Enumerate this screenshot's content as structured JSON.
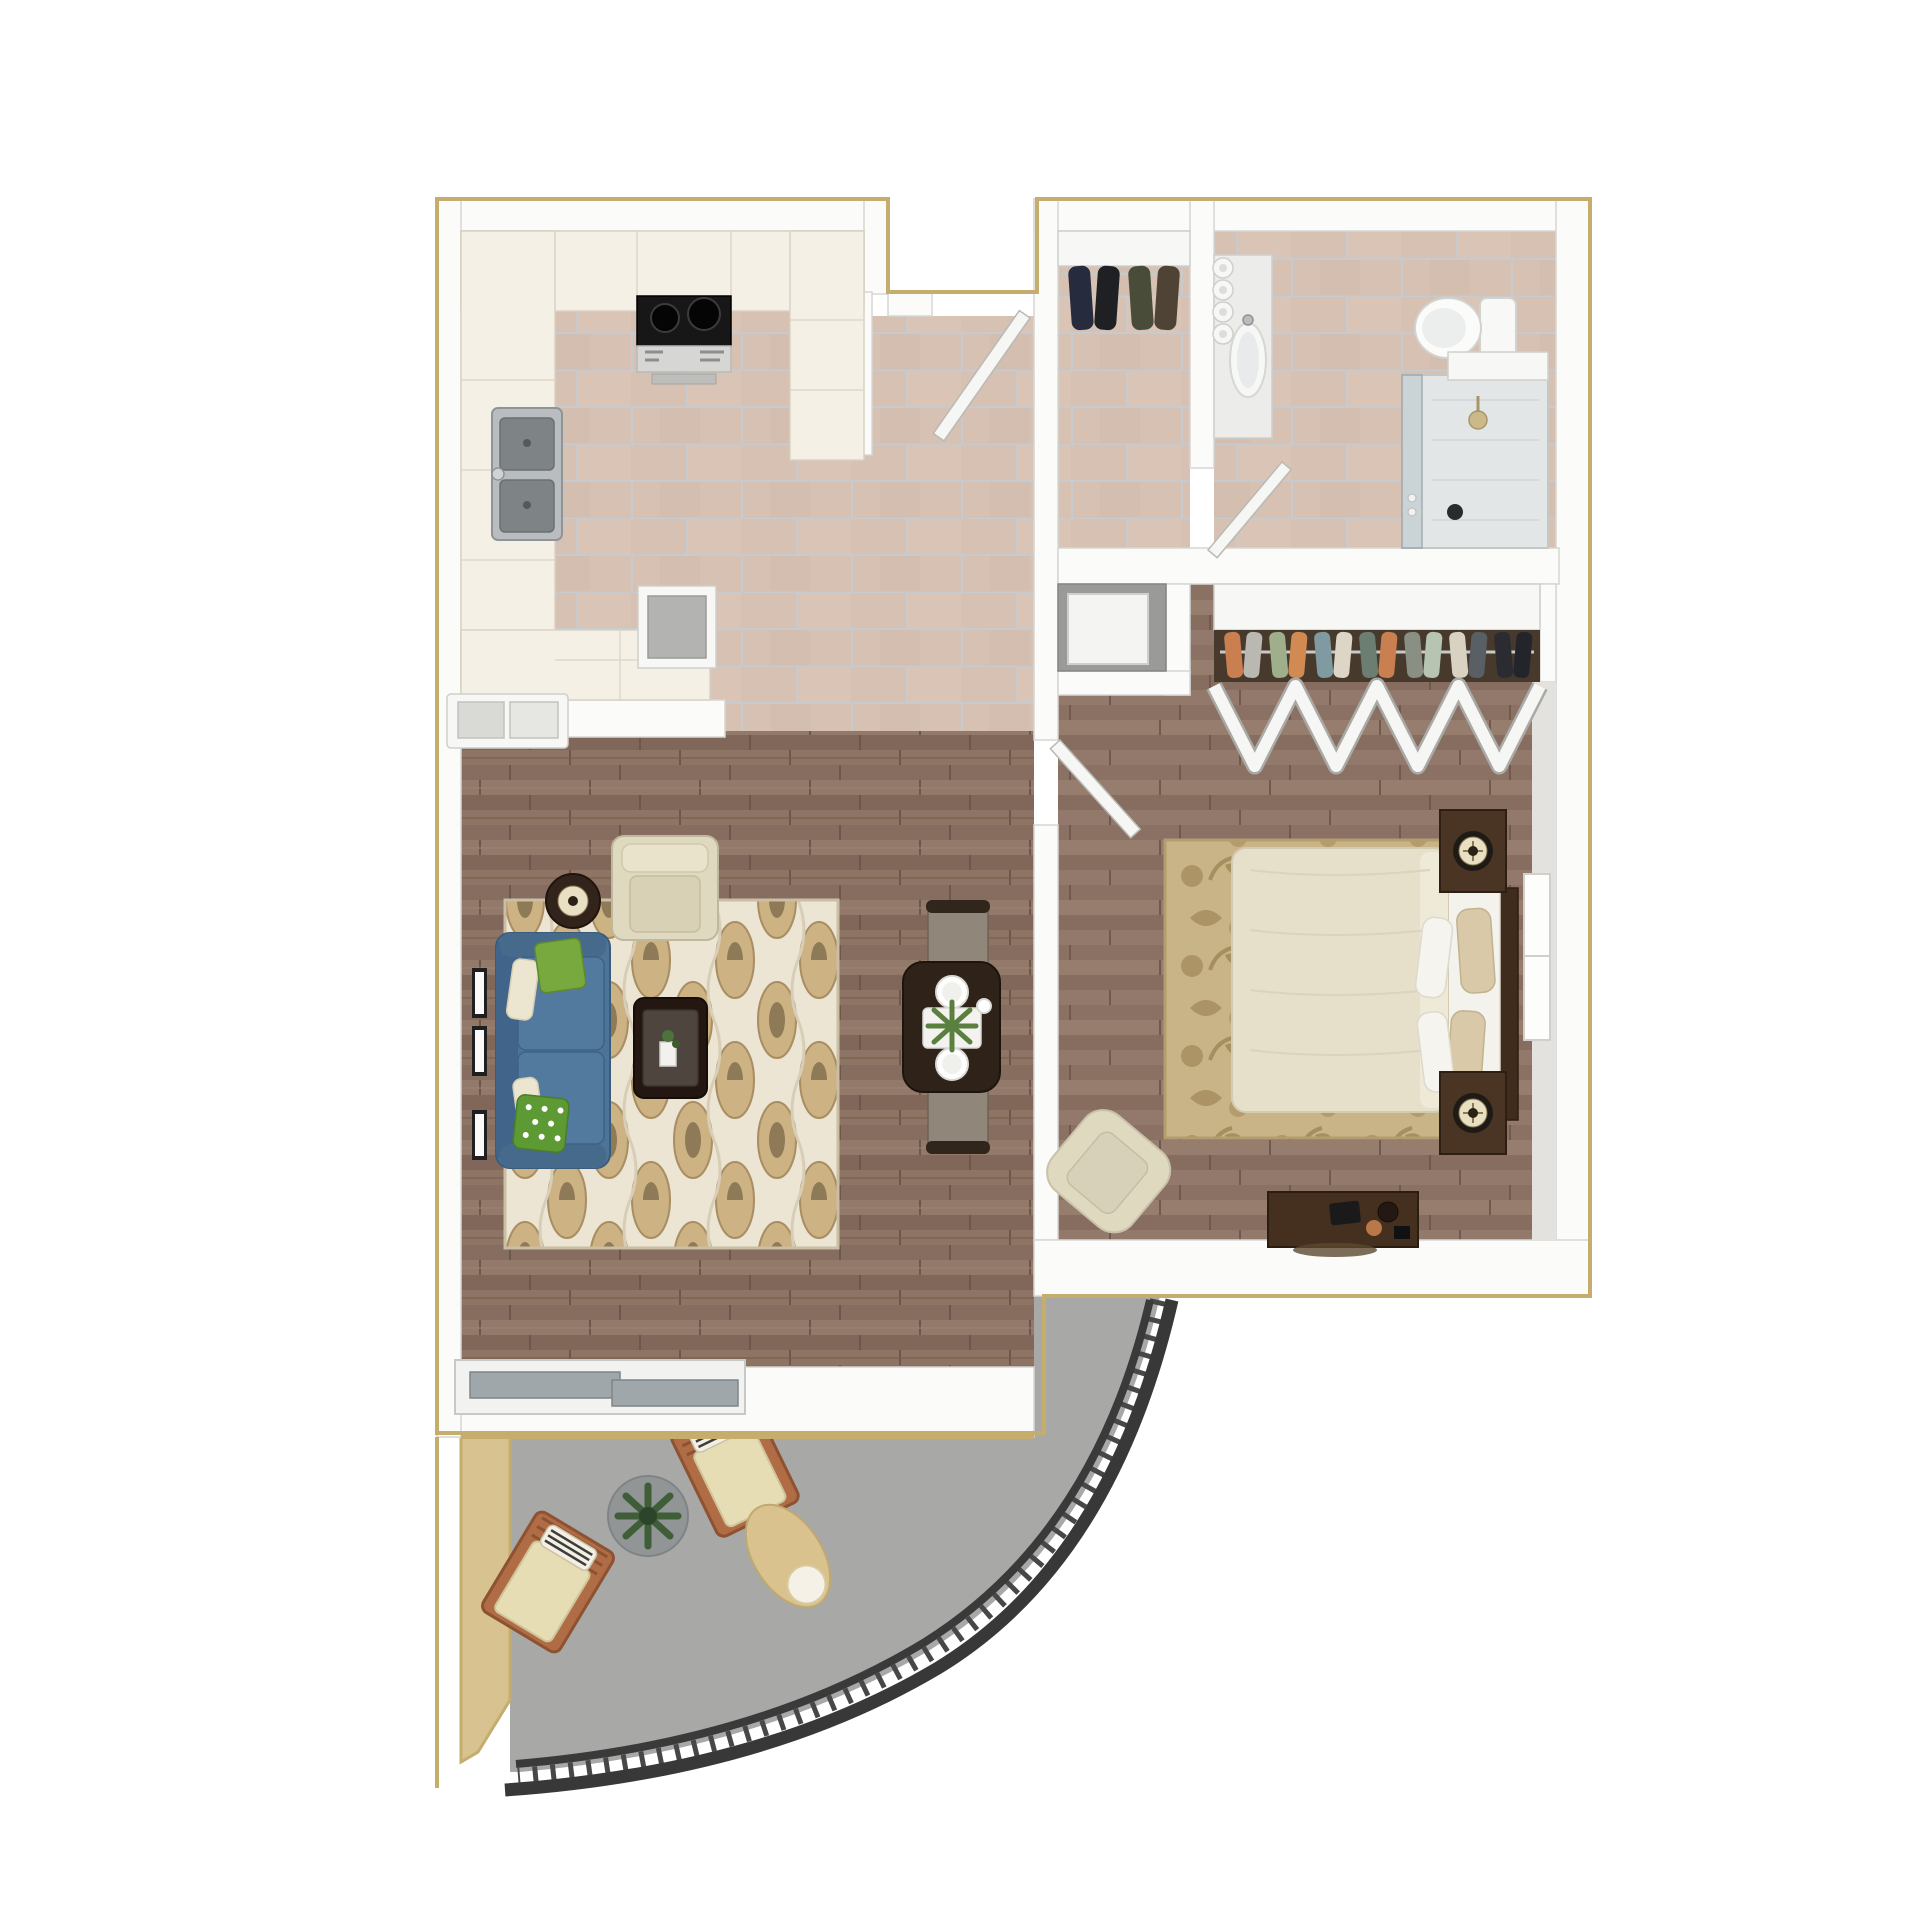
{
  "page": {
    "kind": "3d-floor-plan-render",
    "description": "Top-down 3D render of a one-bedroom apartment floor plan with curved balcony",
    "background": "#ffffff"
  },
  "colors": {
    "gold_trim": "#c5ad6e",
    "wall_white": "#fbfbfa",
    "tile_grout": "#c3ccd4",
    "tile_base": "#d7c1b2",
    "sofa_blue": "#4d7497",
    "sofa_blue_dark": "#41658a",
    "pillow_green": "#77a93e",
    "pillow_cream": "#ece5cf",
    "rug_living_base": "#ece5d4",
    "rug_living_motif": "#cdb283",
    "armchair_cream": "#dfd9c0",
    "coffee_table_dark": "#241711",
    "dining_table_dark": "#2f2319",
    "dining_chair": "#90867a",
    "comforter_cream": "#e6dfca",
    "bed_rug_base": "#c9b488",
    "bed_rug_motif": "#ab9365",
    "nightstand_wood": "#4a3424",
    "headboard_wood": "#3f2c1d",
    "dresser_wood": "#452f1f",
    "balcony_floor": "#a8a8a6",
    "balcony_wall_tan": "#d8c28f",
    "railing_dark": "#3a3a3a",
    "lounge_wood": "#b06c44",
    "lounge_cushion": "#e7ddb4",
    "ottoman_tan": "#d9c28e",
    "stove_black": "#171717",
    "steel": "#b9bdbf",
    "shower_glass": "#c6d0d4",
    "plant_green": "#46663a"
  },
  "rooms": [
    {
      "id": "kitchen",
      "label": "kitchen with U-shaped counters, range and double sink"
    },
    {
      "id": "entry-hall",
      "label": "tiled entry hall with front door and coat closet"
    },
    {
      "id": "bathroom",
      "label": "bathroom with vanity, toilet and shower"
    },
    {
      "id": "utility-closet",
      "label": "utility closet with appliance"
    },
    {
      "id": "bedroom-closet",
      "label": "wardrobe closet with bifold doors"
    },
    {
      "id": "living-dining",
      "label": "living and dining room with hardwood floor"
    },
    {
      "id": "bedroom",
      "label": "bedroom with bed, nightstands, dresser and armchair"
    },
    {
      "id": "balcony",
      "label": "curved balcony with lounge chairs, table and ottoman"
    }
  ],
  "entry_closet": {
    "coat_colors": [
      "#262c3e",
      "#1f2024",
      "#4a4c3a",
      "#4e4335"
    ]
  },
  "bedroom_closet": {
    "clothes_colors": [
      "#c97f4f",
      "#b9b9b2",
      "#9fae8b",
      "#d08a52",
      "#7f9aa0",
      "#ddd6c6",
      "#6c7d72",
      "#c97f4f",
      "#8a8f84",
      "#b7c4b1",
      "#d9d2c2",
      "#586066",
      "#2a2c31",
      "#23252b"
    ]
  }
}
